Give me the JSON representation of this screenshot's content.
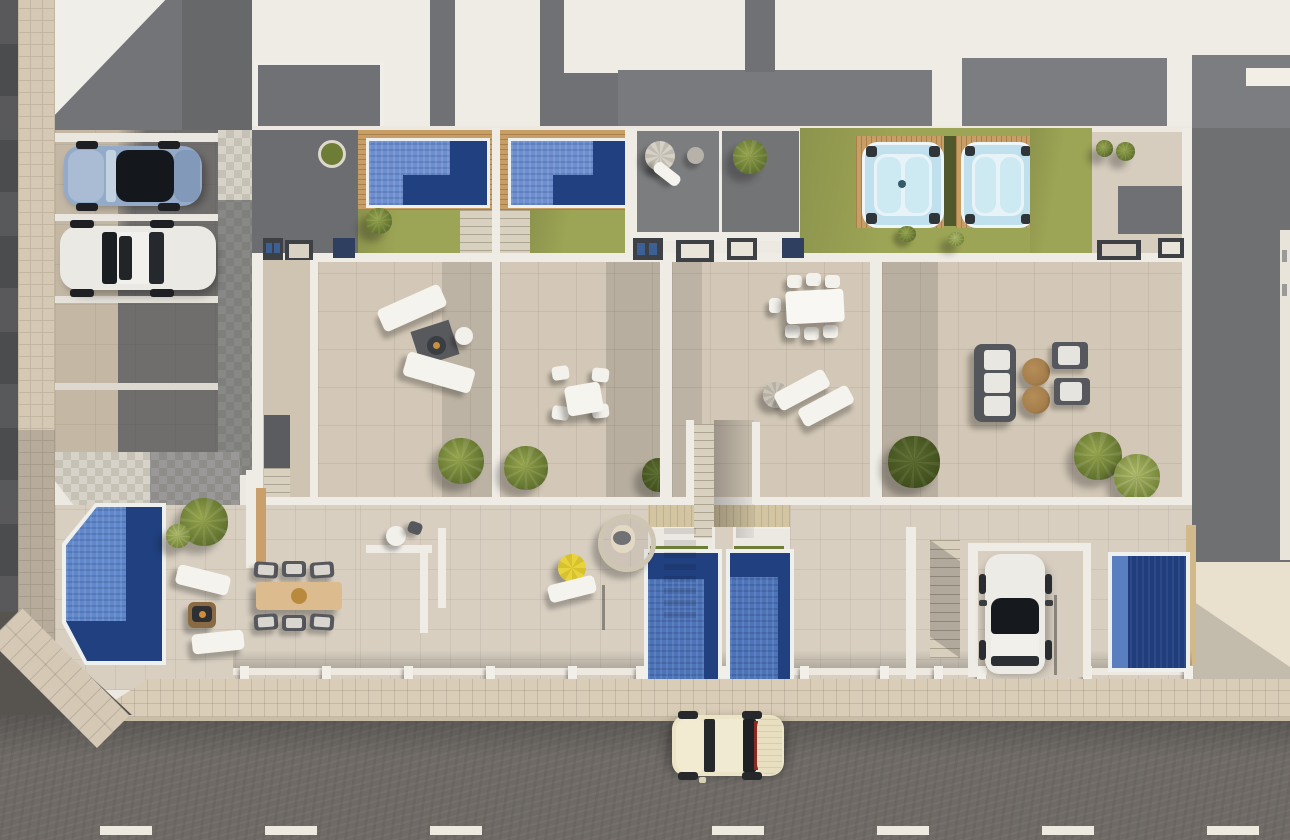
{
  "scene": {
    "label": "Aerial 3D architectural render of four townhouses with rooftop pools, terraces, gardens and a street with parking",
    "width_px": 1290,
    "height_px": 840
  },
  "palette": {
    "white_roof": "#f0eee9",
    "gray_roof": "#75777a",
    "dark_gray_terrace": "#6b6d70",
    "beige_terrace_tile": "#d3c8b7",
    "ground_patio_tile": "#d8cfc1",
    "lawn_green": "#9ca455",
    "rooftop_pool_blue": "#6d8ecf",
    "pool_navy": "#21407f",
    "ground_pool_blue": "#4d73b9",
    "hot_tub_blue": "#bfe0ec",
    "wood_deck": "#c79e66",
    "balcony_wood": "#d3c5a2",
    "sidewalk_beige": "#dacdb7",
    "street_asphalt": "#6f6a66",
    "lane_marking_white": "#efeae0",
    "parasol_yellow": "#e8d33c",
    "pouf_brown": "#a47e4c"
  },
  "objects": {
    "rooftop_band": {
      "label": "White rooftops with skylight openings"
    },
    "rooftop_pool_1": {
      "label": "Rooftop pool with wood deck - unit 1"
    },
    "rooftop_pool_2": {
      "label": "Rooftop pool with wood deck - unit 2"
    },
    "hot_tub_1": {
      "label": "Hot tub on wood deck - unit 3"
    },
    "hot_tub_2": {
      "label": "Hot tub on wood deck - unit 4"
    },
    "lawn": {
      "label": "Artificial lawn"
    },
    "bbq": {
      "label": "Outdoor kitchen / BBQ counter"
    },
    "terrace_1": {
      "label": "Rooftop terrace - unit 1 with sun loungers and fire bowl"
    },
    "terrace_2": {
      "label": "Rooftop terrace - unit 2 with bistro dining set"
    },
    "terrace_3": {
      "label": "Rooftop terrace - unit 3 with dining table and loungers"
    },
    "terrace_4": {
      "label": "Rooftop terrace - unit 4 with sofa lounge set"
    },
    "central_stair": {
      "label": "Shared central staircase"
    },
    "garden_a": {
      "label": "Ground-floor garden with angled pool - unit 1"
    },
    "ground_pool_a": {
      "label": "Ground-floor pool - unit 1"
    },
    "ground_pool_b": {
      "label": "Ground-floor plunge pool - unit 2"
    },
    "ground_pool_c": {
      "label": "Ground-floor plunge pool - unit 3"
    },
    "ground_pool_d": {
      "label": "Ground-floor plunge pool - unit 4"
    },
    "patio_b": {
      "label": "Ground patio with hanging chair and yellow parasol - unit 2"
    },
    "driveway": {
      "label": "Private driveway - unit 4"
    },
    "parking": {
      "label": "Street-side parking bays"
    },
    "car_blue": {
      "label": "Silver-blue sports car in parking bay"
    },
    "car_white": {
      "label": "White car in parking bay"
    },
    "car_driveway": {
      "label": "White car parked on driveway"
    },
    "car_street": {
      "label": "Cream classic car driving on street"
    },
    "street": {
      "label": "Asphalt street with dashed lane markings"
    },
    "sidewalk": {
      "label": "Beige tiled sidewalk"
    },
    "hedge": {
      "label": "Hedge between hot tubs"
    },
    "planter": {
      "label": "Round planter"
    },
    "hanging_chair": {
      "label": "Hanging egg chair"
    },
    "parasol_yellow": {
      "label": "Yellow parasol"
    },
    "sofa_set": {
      "label": "Outdoor sofa with poufs and armchairs"
    }
  },
  "counts": {
    "townhouse_units": 4,
    "rooftop_pools": 2,
    "hot_tubs": 2,
    "ground_pools": 4,
    "cars": 4,
    "lane_dashes": 7,
    "parking_bays": 2
  }
}
